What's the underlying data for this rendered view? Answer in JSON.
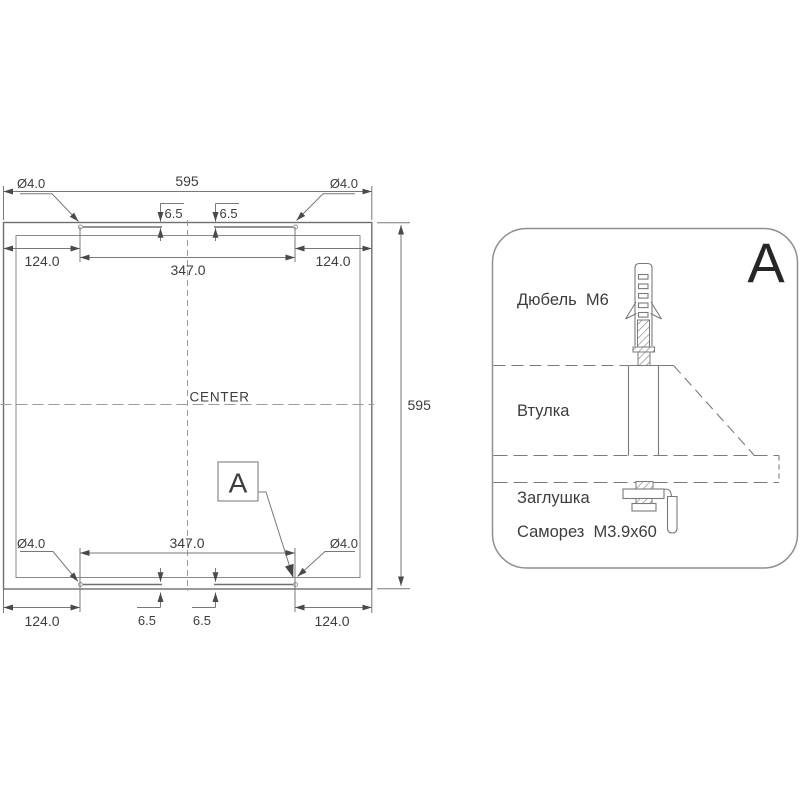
{
  "main_view": {
    "width_label": "595",
    "height_label": "595",
    "center_label": "CENTER",
    "callout_label": "A",
    "hole_labels": {
      "top_left": "Ø4.0",
      "top_right": "Ø4.0",
      "bottom_left": "Ø4.0",
      "bottom_right": "Ø4.0"
    },
    "offset_124": {
      "top_left": "124.0",
      "top_right": "124.0",
      "bottom_left": "124.0",
      "bottom_right": "124.0"
    },
    "span_347": {
      "top": "347.0",
      "bottom": "347.0"
    },
    "slot_depth_65": {
      "top_left": "6.5",
      "top_right": "6.5",
      "bottom_left": "6.5",
      "bottom_right": "6.5"
    }
  },
  "detail_view": {
    "title": "A",
    "dowel_label": "Дюбель  М6",
    "sleeve_label": "Втулка",
    "plug_label": "Заглушка",
    "screw_label": "Саморез  М3.9х60"
  }
}
